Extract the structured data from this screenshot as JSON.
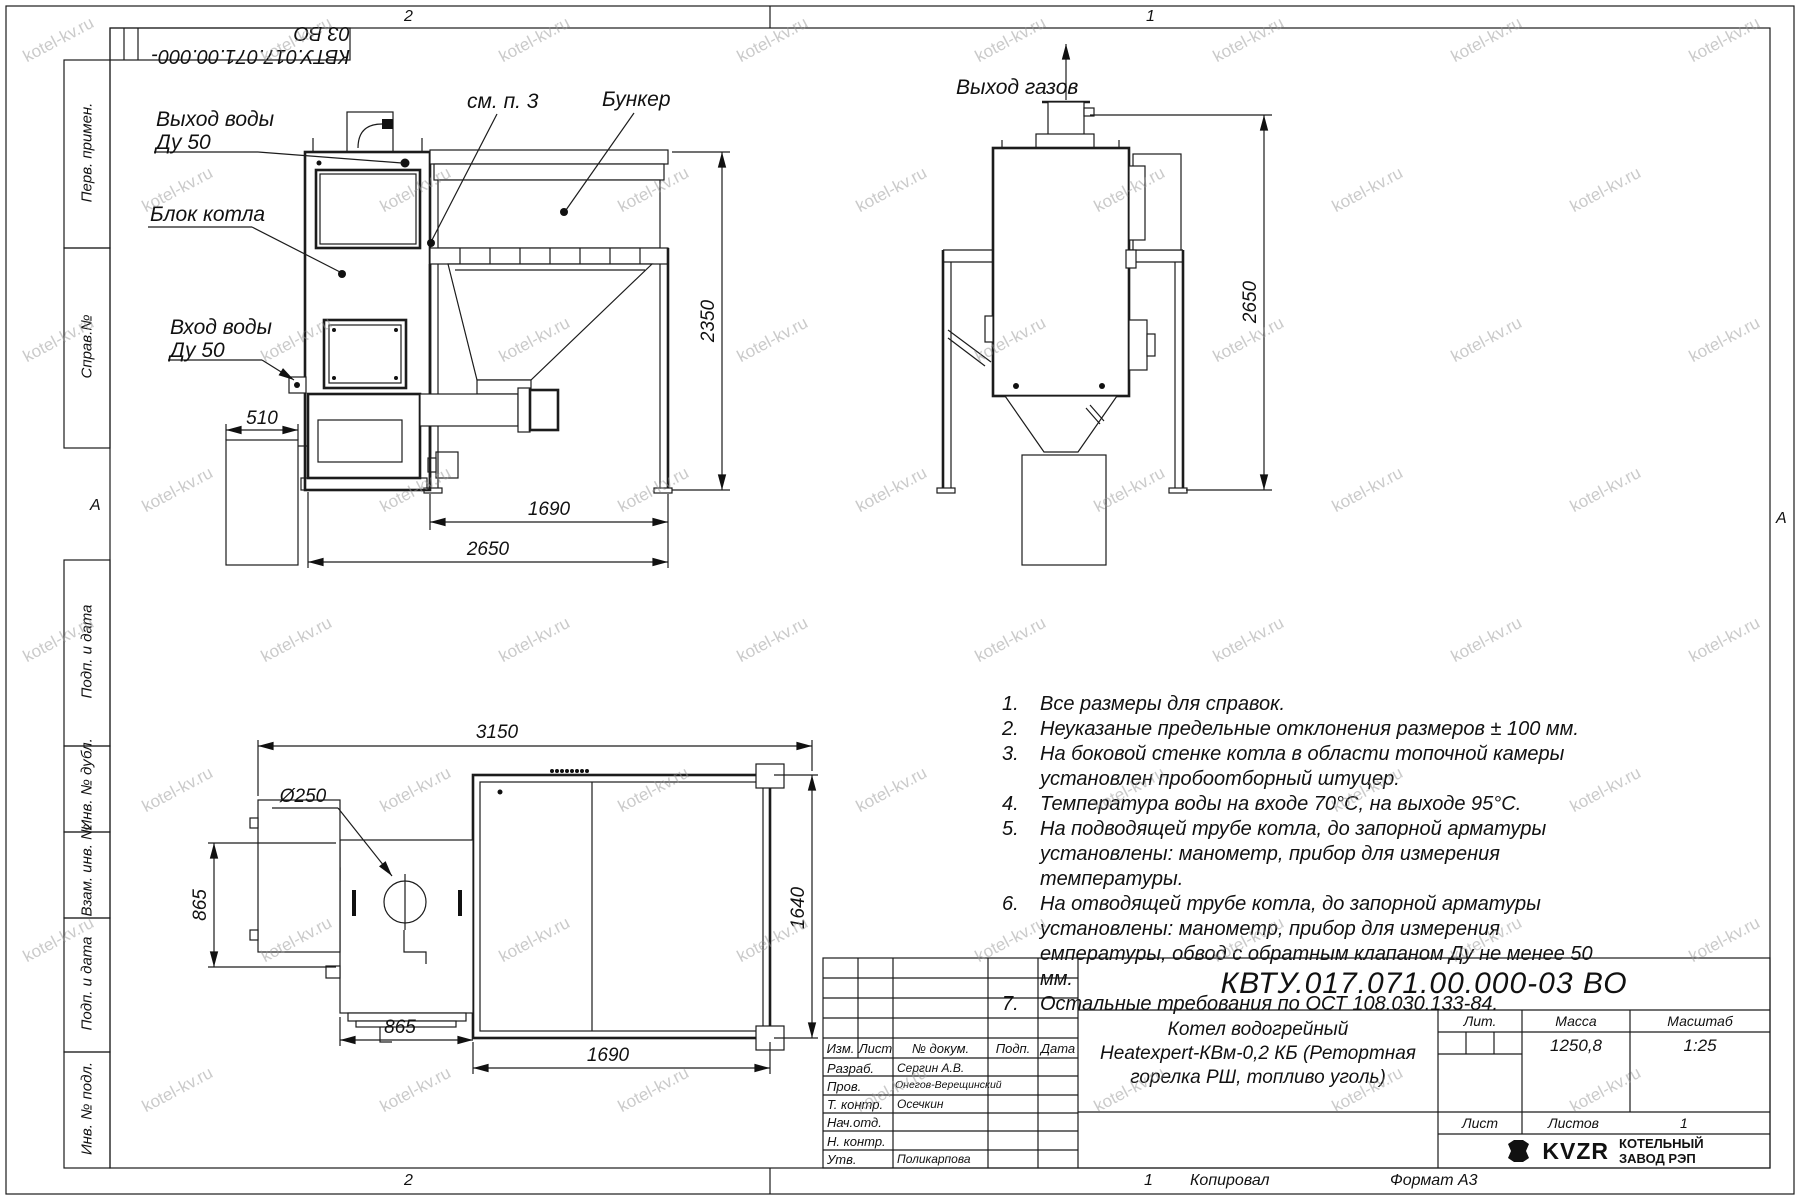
{
  "sheet": {
    "doc_number": "КВТУ.017.071.00.000-03 ВО",
    "zones": {
      "top_left": "2",
      "top_right": "1",
      "bottom_left": "2",
      "bottom_right": "1",
      "row_letter_left": "А",
      "row_letter_right": "А"
    },
    "footer": {
      "copied": "Копировал",
      "format": "Формат А3"
    },
    "stamps": {
      "s1": "Перв. примен.",
      "s2": "Справ.№",
      "s3": "Подп. и дата",
      "s4": "Инв. № дубл.",
      "s5": "Взам. инв. №",
      "s6": "Подп. и дата",
      "s7": "Инв. № подл."
    }
  },
  "watermark": {
    "text": "kotel-kv.ru",
    "cols": 8,
    "rows": 8,
    "x0": 20,
    "dx": 238,
    "y0": 30,
    "dy": 150,
    "stagger": 119
  },
  "views": {
    "front": {
      "label_water_out_l1": "Выход воды",
      "label_water_out_l2": "Ду 50",
      "label_see_note": "см. п. 3",
      "label_bunker": "Бункер",
      "label_boiler": "Блок котла",
      "label_water_in_l1": "Вход воды",
      "label_water_in_l2": "Ду 50",
      "dim_510": "510",
      "dim_2350": "2350",
      "dim_1690": "1690",
      "dim_2650": "2650"
    },
    "side": {
      "label_gas_out": "Выход газов",
      "dim_2650": "2650"
    },
    "plan": {
      "dim_3150": "3150",
      "dim_diam": "Ø250",
      "dim_865_v": "865",
      "dim_865_h": "865",
      "dim_1690": "1690",
      "dim_1640": "1640"
    }
  },
  "notes": {
    "items": [
      {
        "num": "1.",
        "text": "Все размеры для справок."
      },
      {
        "num": "2.",
        "text": "Неуказаные предельные отклонения размеров ± 100 мм."
      },
      {
        "num": "3.",
        "text": "На боковой стенке котла в области топочной камеры установлен пробоотборный штуцер."
      },
      {
        "num": "4.",
        "text": "Температура воды на входе 70°С, на выходе 95°С."
      },
      {
        "num": "5.",
        "text": "На подводящей трубе котла, до запорной арматуры установлены: манометр, прибор для измерения температуры."
      },
      {
        "num": "6.",
        "text": "На отводящей трубе котла, до запорной арматуры установлены: манометр, прибор для измерения емпературы, обвод с обратным клапаном Ду не менее 50 мм."
      },
      {
        "num": "7.",
        "text": "Остальные требования по ОСТ 108.030.133-84."
      }
    ]
  },
  "title_block": {
    "doc_number": "КВТУ.017.071.00.000-03 ВО",
    "name_line1": "Котел водогрейный",
    "name_line2": "Heatexpert-КВм-0,2 КБ (Ретортная",
    "name_line3": "горелка РШ, топливо уголь)",
    "col_headers": {
      "izm": "Изм.",
      "list": "Лист",
      "doc": "№ докум.",
      "podp": "Подп.",
      "data": "Дата"
    },
    "staff": [
      {
        "role": "Разраб.",
        "name": "Сергин А.В."
      },
      {
        "role": "Пров.",
        "name": "Онегов-Верещинский"
      },
      {
        "role": "Т. контр.",
        "name": "Осечкин"
      },
      {
        "role": "Нач.отд.",
        "name": ""
      },
      {
        "role": "Н. контр.",
        "name": ""
      },
      {
        "role": "Утв.",
        "name": "Поликарпова"
      }
    ],
    "lit_label": "Лит.",
    "mass_label": "Масса",
    "scale_label": "Масштаб",
    "mass_value": "1250,8",
    "scale_value": "1:25",
    "sheet_label": "Лист",
    "sheets_label": "Листов",
    "sheets_value": "1",
    "company": {
      "logo": "KVZR",
      "line1": "КОТЕЛЬНЫЙ",
      "line2": "ЗАВОД РЭП"
    }
  }
}
